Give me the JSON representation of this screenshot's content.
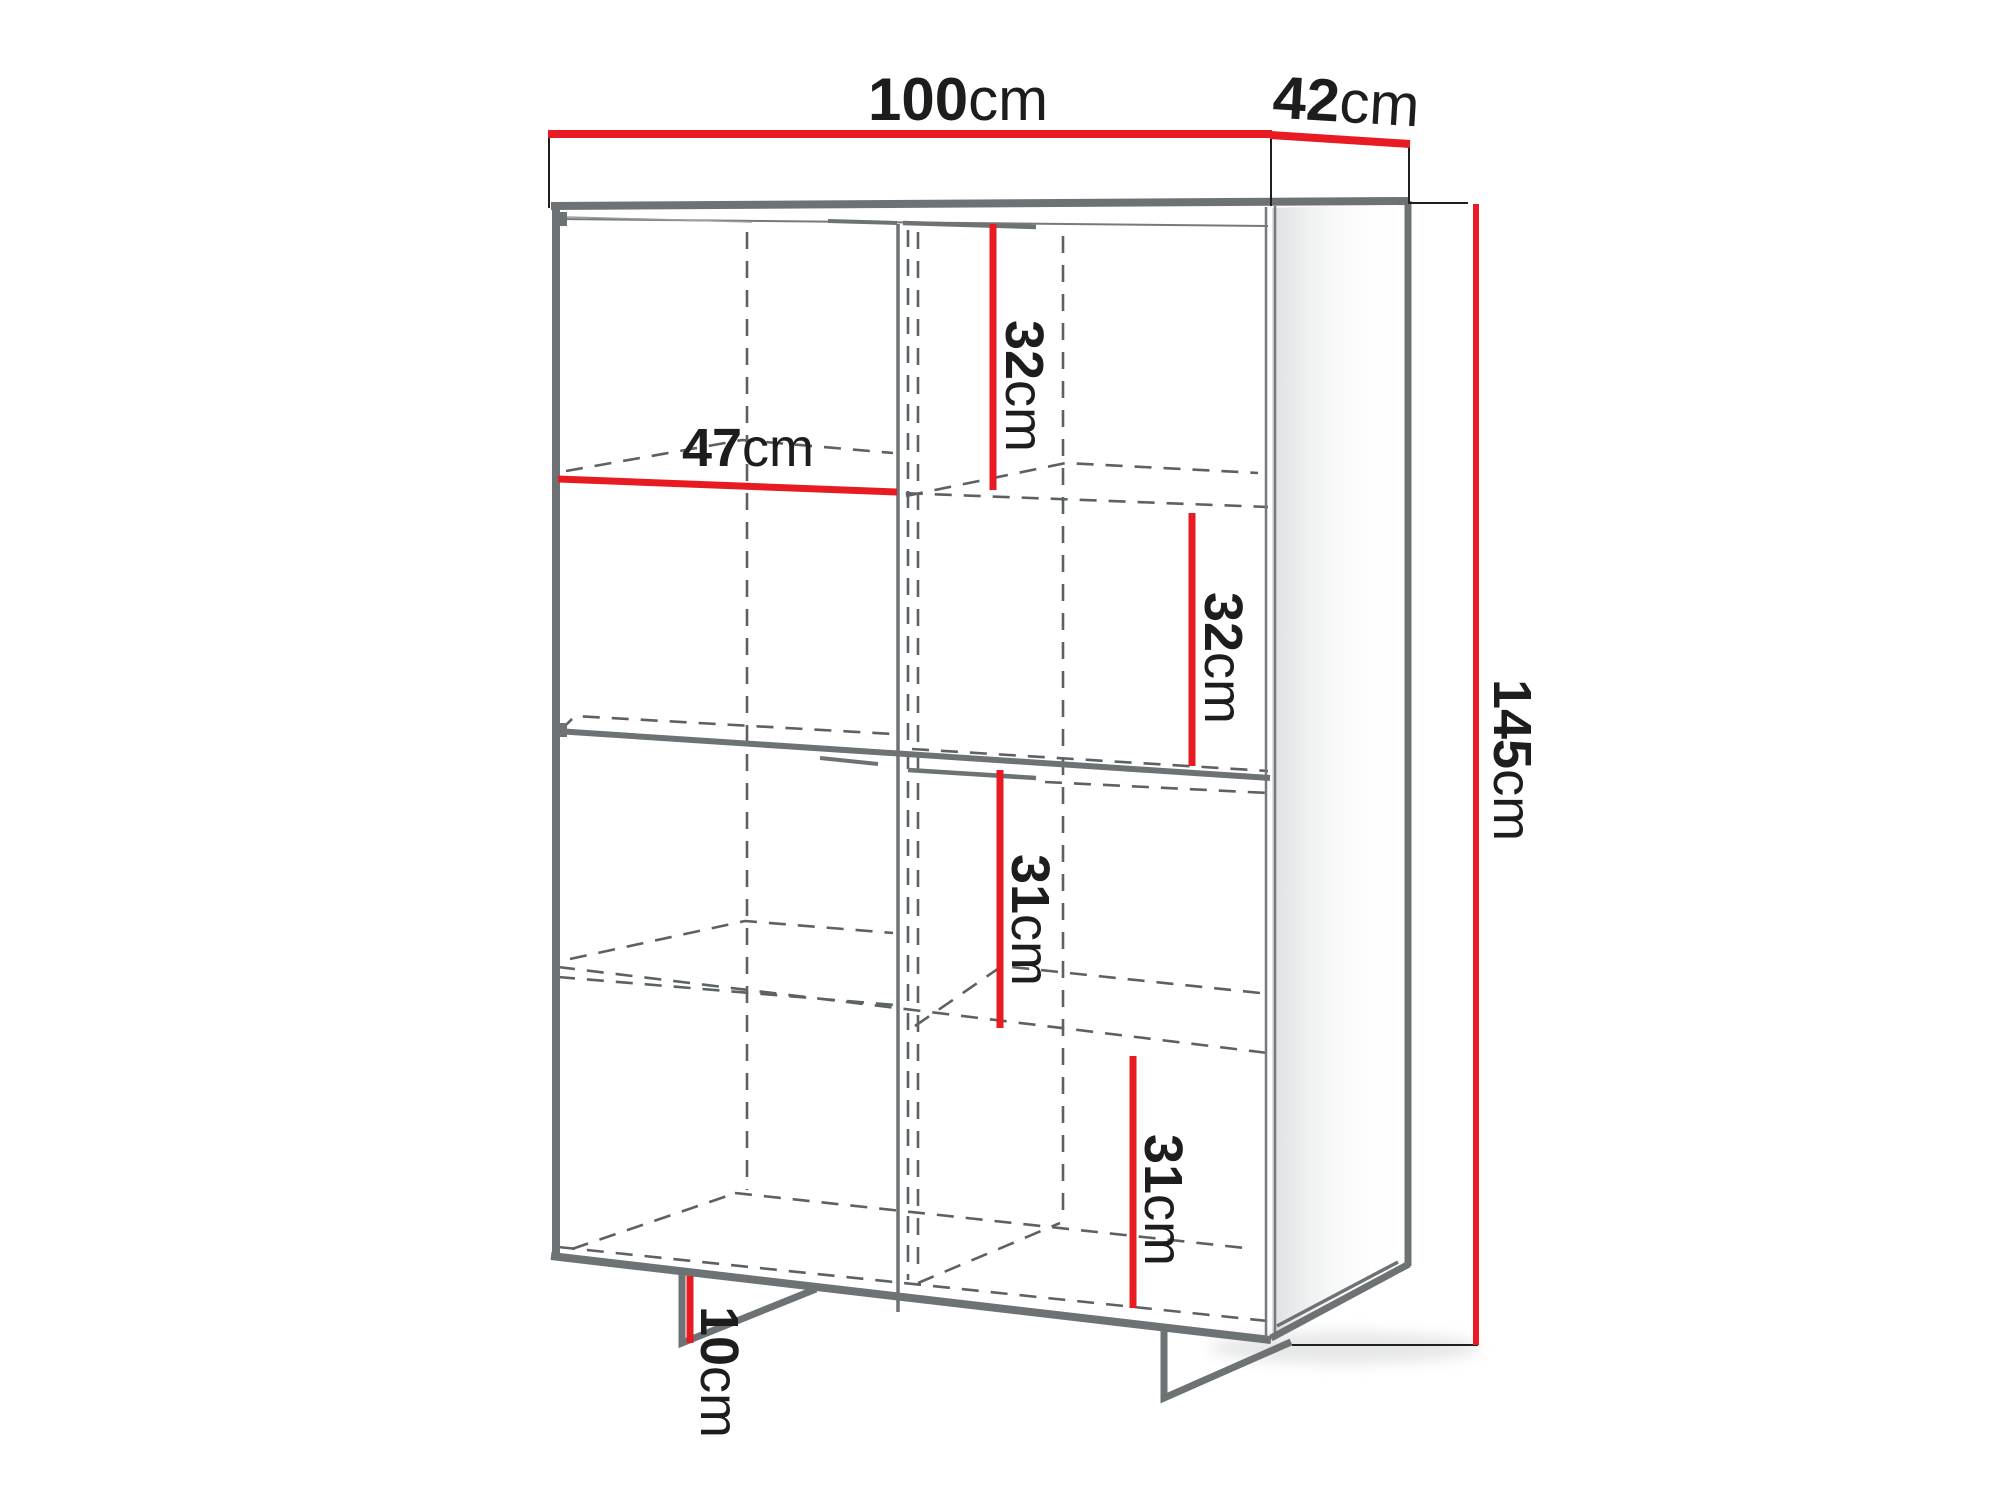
{
  "diagram": {
    "type": "furniture-dimension-diagram",
    "subject": "two-door highboard cabinet with interior shelves and angled metal feet",
    "unit": "cm",
    "colors": {
      "dimension_line": "#e81b22",
      "outline": "#6d7275",
      "extension_line": "#1f1f1f",
      "text": "#1d1d1b",
      "background": "#ffffff"
    },
    "labels": {
      "width": {
        "value": "100",
        "unit": "cm"
      },
      "depth": {
        "value": "42",
        "unit": "cm"
      },
      "height": {
        "value": "145",
        "unit": "cm"
      },
      "shelf_width": {
        "value": "47",
        "unit": "cm"
      },
      "section_top_right": {
        "value": "32",
        "unit": "cm"
      },
      "section_upper_right": {
        "value": "32",
        "unit": "cm"
      },
      "section_lower_right": {
        "value": "31",
        "unit": "cm"
      },
      "section_bottom_right": {
        "value": "31",
        "unit": "cm"
      },
      "leg_height": {
        "value": "10",
        "unit": "cm"
      }
    }
  }
}
